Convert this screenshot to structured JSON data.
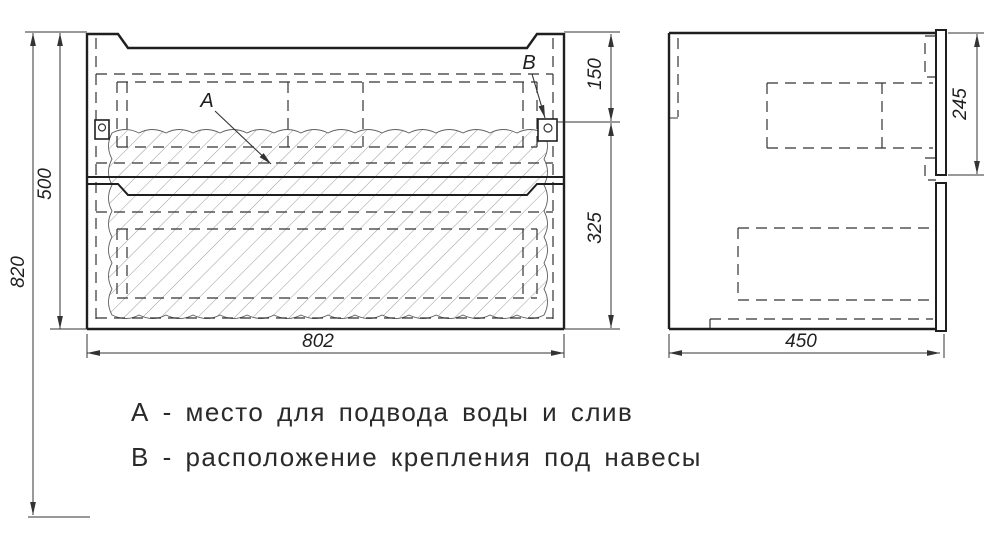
{
  "drawing": {
    "dimensions": {
      "overall_height": "820",
      "cabinet_height": "500",
      "cabinet_width": "802",
      "top_to_mount": "150",
      "mount_to_bottom": "325",
      "depth": "450",
      "front_panel_height": "245"
    },
    "labels": {
      "point_a": "А",
      "point_b": "В"
    },
    "notes": {
      "line_a": "А - место для подвода воды и слив",
      "line_b": "В - расположение крепления под навесы"
    },
    "colors": {
      "background": "#ffffff",
      "line": "#1f1f1f",
      "hatch": "#9b9b9b"
    }
  }
}
